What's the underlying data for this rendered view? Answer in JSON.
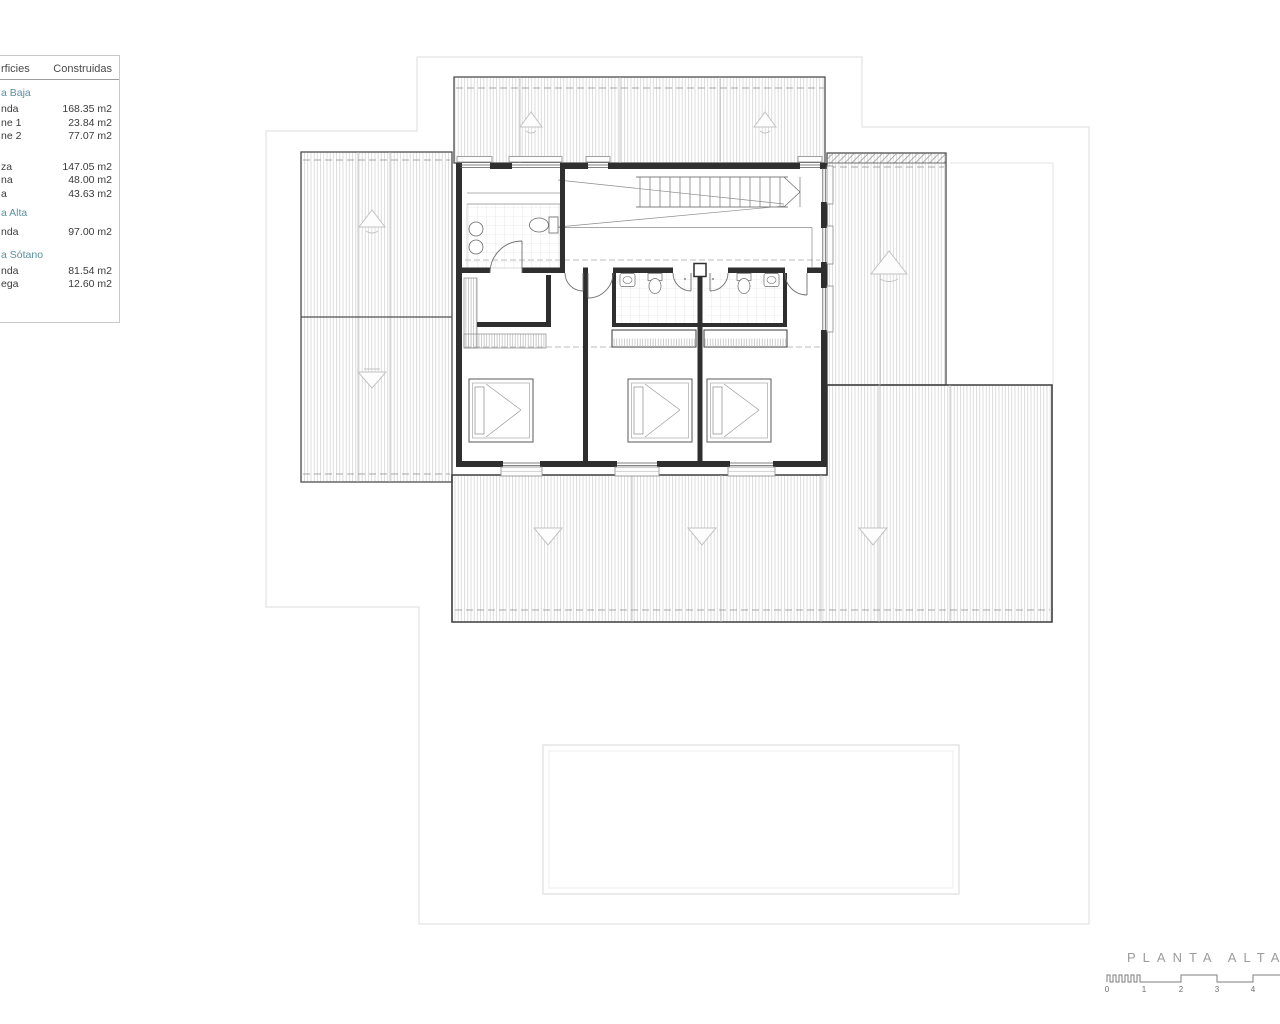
{
  "surfaces_table": {
    "headers": {
      "left": "rficies",
      "right": "Construidas"
    },
    "sections": [
      {
        "title": "a Baja",
        "rows": [
          {
            "label": "nda",
            "value": "168.35 m2"
          },
          {
            "label": "ne 1",
            "value": "23.84 m2"
          },
          {
            "label": "ne 2",
            "value": "77.07 m2"
          }
        ]
      },
      {
        "title": "",
        "rows": [
          {
            "label": "za",
            "value": "147.05 m2"
          },
          {
            "label": "na",
            "value": "48.00 m2"
          },
          {
            "label": "a",
            "value": "43.63 m2"
          }
        ]
      },
      {
        "title": "a Alta",
        "rows": [
          {
            "label": "nda",
            "value": "97.00 m2"
          }
        ]
      },
      {
        "title": "a Sótano",
        "rows": [
          {
            "label": "nda",
            "value": "81.54 m2"
          },
          {
            "label": "ega",
            "value": "12.60 m2"
          }
        ]
      }
    ]
  },
  "title_block": {
    "drawing_title": "PLANTA ALTA",
    "scale_labels": [
      "0",
      "1",
      "2",
      "3",
      "4"
    ]
  },
  "colors": {
    "section_heading": "#5a8f9f",
    "table_text": "#3b3b3b",
    "wall": "#2f2f2f",
    "roof_stripe": "#cdcdcd",
    "boundary": "#dcdcdc",
    "drawing_title_gray": "#9b9b9b"
  }
}
